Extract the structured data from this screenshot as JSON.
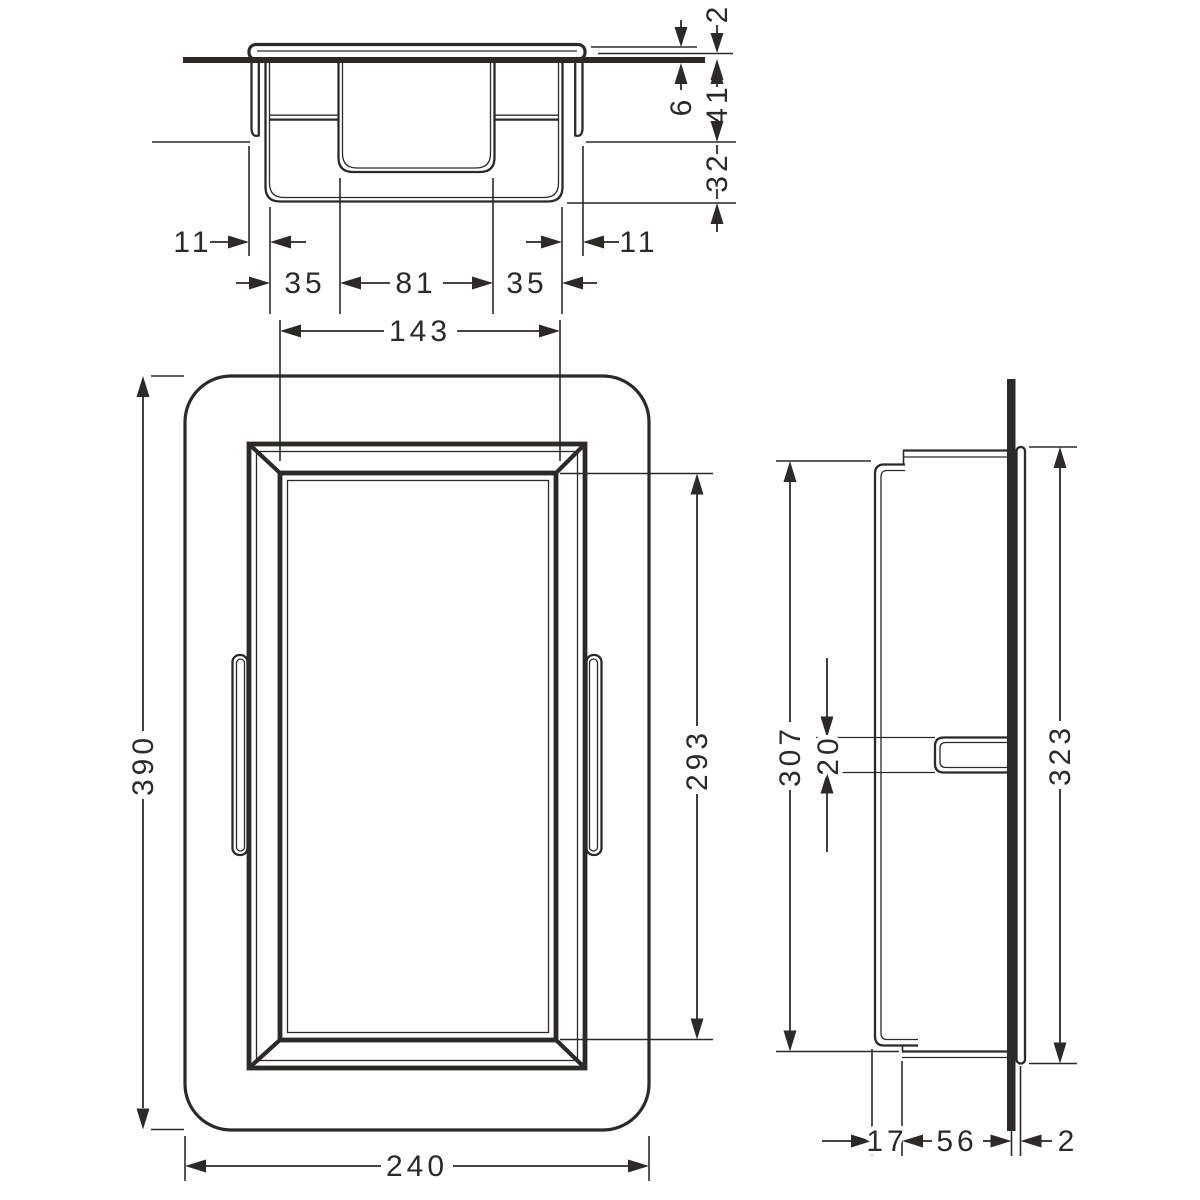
{
  "colors": {
    "line": "#2b2a29",
    "background": "#ffffff"
  },
  "views": {
    "top": {
      "flange_protrusion": "2",
      "tile_thickness": "6",
      "collar_depth": "41",
      "rear_step_depth": "32",
      "overhang_left": "11",
      "overhang_right": "11",
      "recess_side_left": "35",
      "recess_center": "81",
      "recess_side_right": "35"
    },
    "front": {
      "opening_width": "143",
      "body_height": "390",
      "opening_height": "293",
      "body_width": "240"
    },
    "side": {
      "frame_inner_height": "307",
      "clip_height": "20",
      "flange_height": "323",
      "rear_depth": "17",
      "install_depth": "56",
      "flange_thickness": "2"
    }
  }
}
